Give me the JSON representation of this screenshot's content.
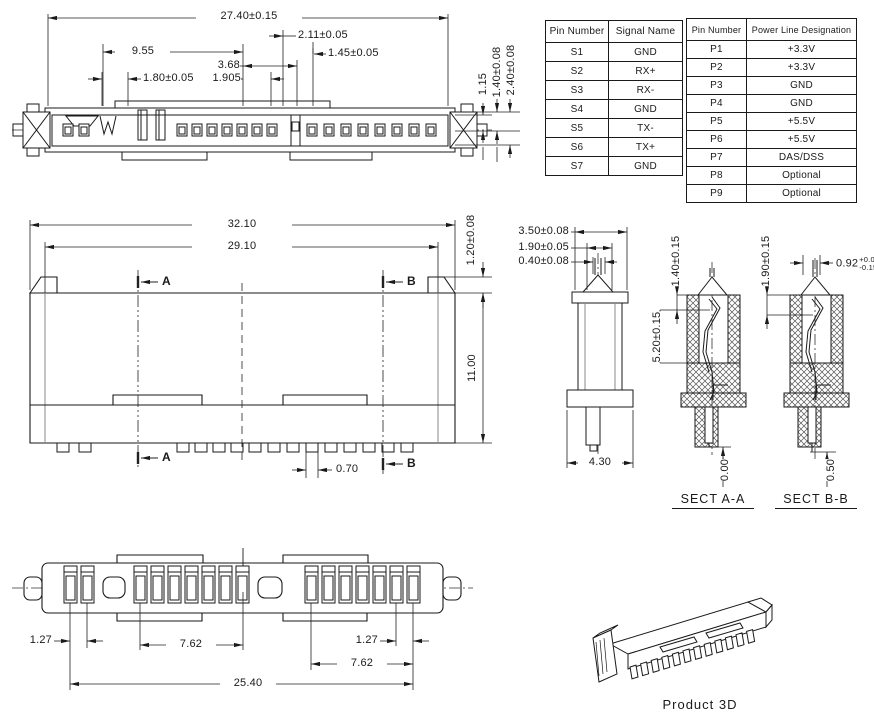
{
  "top_view": {
    "dims": {
      "overall": "27.40±0.15",
      "span_955": "9.55",
      "d_368": "3.68",
      "d_180": "1.80±0.05",
      "d_1905": "1.905",
      "d_211": "2.11±0.05",
      "d_145": "1.45±0.05",
      "h_115": "1.15",
      "h_140": "1.40±0.08",
      "h_240": "2.40±0.08"
    }
  },
  "front_view": {
    "dims": {
      "overall": "32.10",
      "inner": "29.10",
      "ear_height": "1.20±0.08",
      "height": "11.00",
      "pad_width": "0.70"
    },
    "markers": {
      "a": "A",
      "b": "B"
    }
  },
  "side_view": {
    "dims": {
      "top_width": "3.50±0.08",
      "mid_width": "1.90±0.05",
      "tip_width": "0.40±0.08",
      "base_width": "4.30"
    }
  },
  "sect_aa": {
    "label": "SECT A-A",
    "dims": {
      "depth_top": "1.40±0.15",
      "depth_mid": "5.20±0.15",
      "bottom_ref": "0.00"
    }
  },
  "sect_bb": {
    "label": "SECT B-B",
    "dims": {
      "depth_top": "1.90±0.15",
      "pin_width": "0.92",
      "pin_tol_plus": "+0.05",
      "pin_tol_minus": "-0.15",
      "bottom_ref": "0.50"
    }
  },
  "bottom_view": {
    "dims": {
      "pitch_left": "1.27",
      "span_left": "7.62",
      "pitch_right": "1.27",
      "span_right": "7.62",
      "overall": "25.40"
    }
  },
  "product_3d": {
    "label": "Product 3D"
  },
  "tables": {
    "signal": {
      "headers": [
        "Pin Number",
        "Signal Name"
      ],
      "rows": [
        {
          "pin": "S1",
          "value": "GND"
        },
        {
          "pin": "S2",
          "value": "RX+"
        },
        {
          "pin": "S3",
          "value": "RX-"
        },
        {
          "pin": "S4",
          "value": "GND"
        },
        {
          "pin": "S5",
          "value": "TX-"
        },
        {
          "pin": "S6",
          "value": "TX+"
        },
        {
          "pin": "S7",
          "value": "GND"
        }
      ]
    },
    "power": {
      "headers": [
        "Pin Number",
        "Power Line Designation"
      ],
      "rows": [
        {
          "pin": "P1",
          "value": "+3.3V"
        },
        {
          "pin": "P2",
          "value": "+3.3V"
        },
        {
          "pin": "P3",
          "value": "GND"
        },
        {
          "pin": "P4",
          "value": "GND"
        },
        {
          "pin": "P5",
          "value": "+5.5V"
        },
        {
          "pin": "P6",
          "value": "+5.5V"
        },
        {
          "pin": "P7",
          "value": "DAS/DSS"
        },
        {
          "pin": "P8",
          "value": "Optional"
        },
        {
          "pin": "P9",
          "value": "Optional"
        }
      ]
    }
  }
}
